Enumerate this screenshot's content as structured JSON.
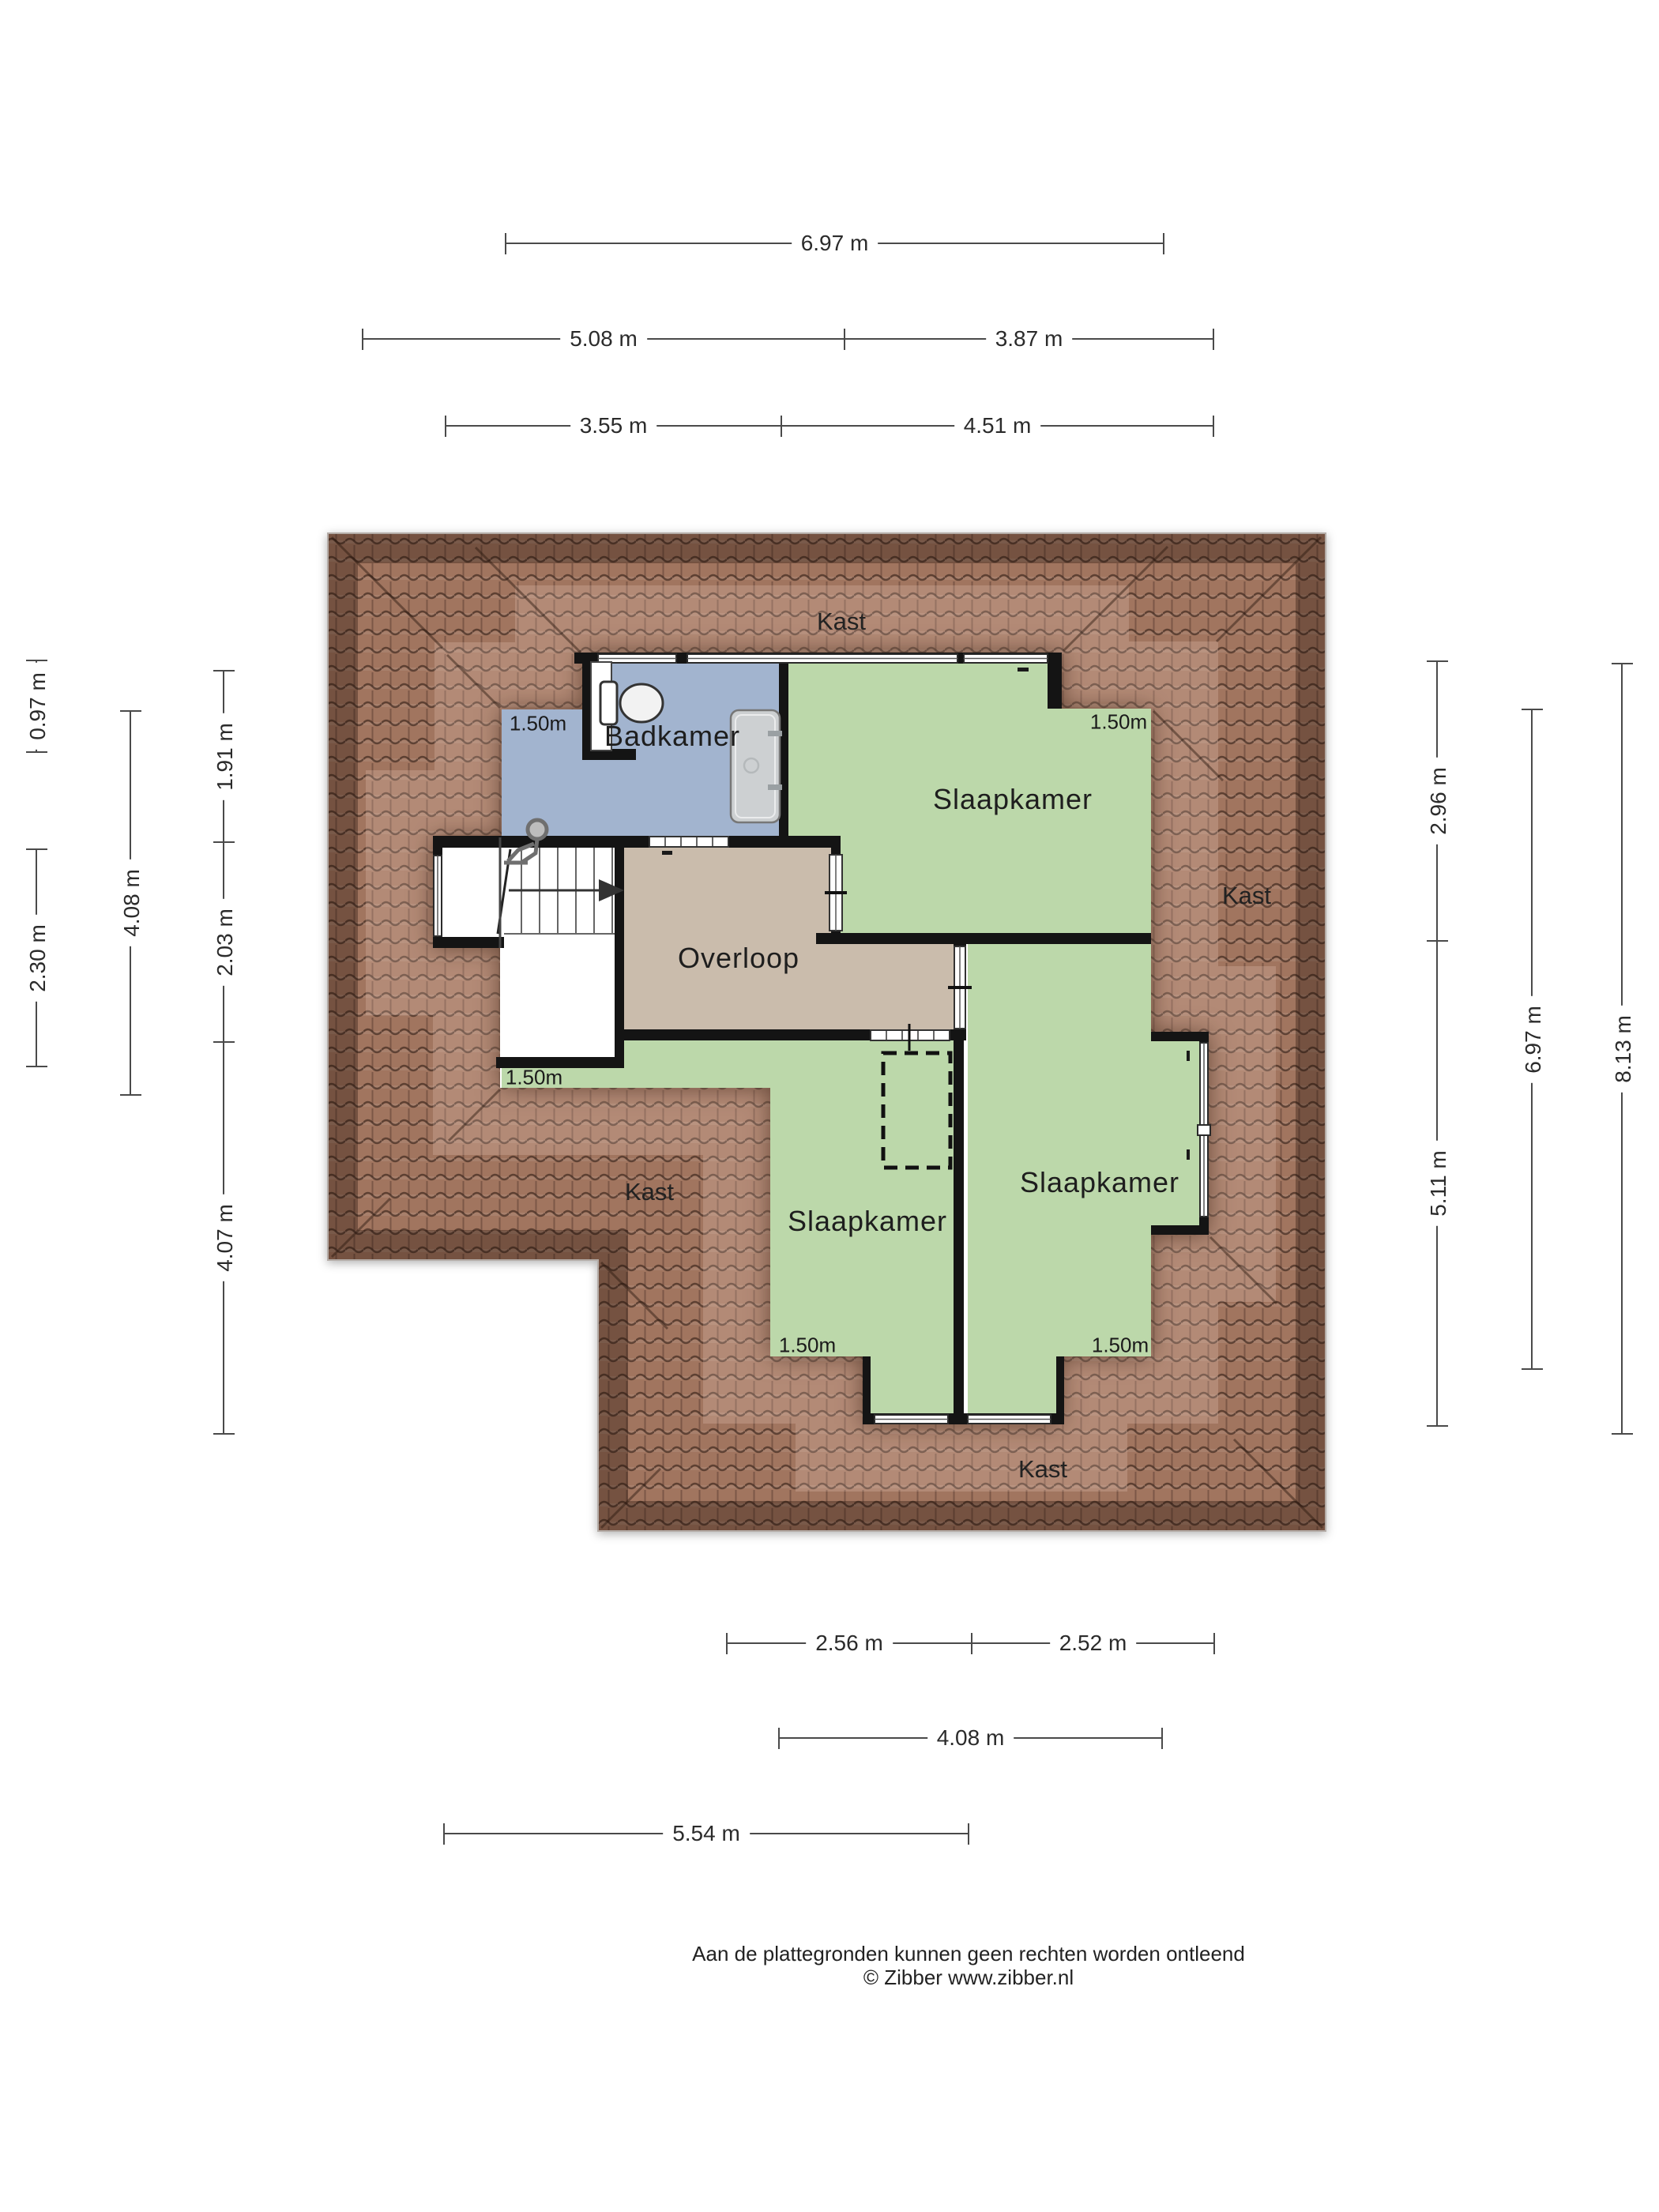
{
  "plan_type": "attic floor plan",
  "colors": {
    "roof": "#a1755f",
    "roof_line": "#3c281f",
    "bedroom_green": "#bcd8aa",
    "bathroom_blue": "#a2b4cf",
    "landing_taupe": "#cabcac",
    "wall_black": "#141414",
    "dimension_gray": "#4a4a4a"
  },
  "rooms": [
    {
      "id": "badkamer",
      "name": "Badkamer"
    },
    {
      "id": "slaapkamer-top",
      "name": "Slaapkamer"
    },
    {
      "id": "overloop",
      "name": "Overloop"
    },
    {
      "id": "slaapkamer-middle",
      "name": "Slaapkamer"
    },
    {
      "id": "slaapkamer-right",
      "name": "Slaapkamer"
    }
  ],
  "closets": [
    {
      "id": "kast-top",
      "name": "Kast"
    },
    {
      "id": "kast-right",
      "name": "Kast"
    },
    {
      "id": "kast-left",
      "name": "Kast"
    },
    {
      "id": "kast-bottom",
      "name": "Kast"
    }
  ],
  "height_markers": [
    {
      "id": "badkamer",
      "label": "1.50m"
    },
    {
      "id": "slaapkamer-top",
      "label": "1.50m"
    },
    {
      "id": "slaapkamer-middle-top",
      "label": "1.50m"
    },
    {
      "id": "slaapkamer-middle-bottom",
      "label": "1.50m"
    },
    {
      "id": "slaapkamer-right-bottom",
      "label": "1.50m"
    }
  ],
  "dims": {
    "top": [
      {
        "label": "6.97 m"
      },
      {
        "label": "5.08 m"
      },
      {
        "label": "3.87 m"
      },
      {
        "label": "3.55 m"
      },
      {
        "label": "4.51 m"
      }
    ],
    "left": [
      {
        "label": "0.97 m"
      },
      {
        "label": "2.30 m"
      },
      {
        "label": "4.08 m"
      },
      {
        "label": "1.91 m"
      },
      {
        "label": "2.03 m"
      },
      {
        "label": "4.07 m"
      }
    ],
    "right": [
      {
        "label": "2.96 m"
      },
      {
        "label": "5.11 m"
      },
      {
        "label": "6.97 m"
      },
      {
        "label": "8.13 m"
      }
    ],
    "bottom": [
      {
        "label": "2.56 m"
      },
      {
        "label": "2.52 m"
      },
      {
        "label": "4.08 m"
      },
      {
        "label": "5.54 m"
      }
    ]
  },
  "footer": {
    "disclaimer": "Aan de plattegronden kunnen geen rechten worden ontleend",
    "copyright": "© Zibber www.zibber.nl"
  }
}
